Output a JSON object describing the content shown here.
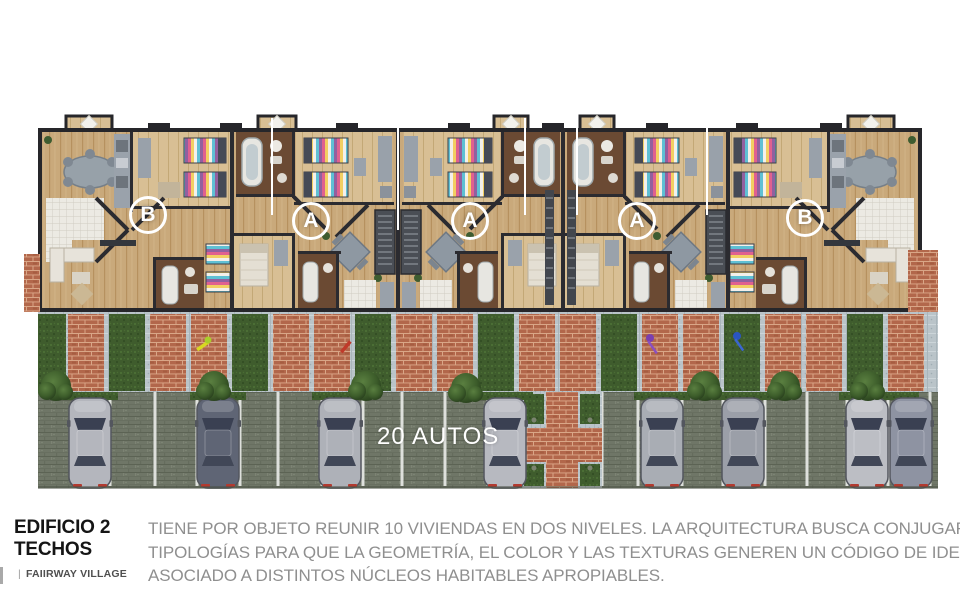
{
  "plan": {
    "units": [
      {
        "label": "B"
      },
      {
        "label": "A"
      },
      {
        "label": "A"
      },
      {
        "label": "A"
      },
      {
        "label": "B"
      }
    ],
    "parking_label": "20 AUTOS",
    "visible_cars": 8
  },
  "footer": {
    "title_line1": "EDIFICIO 2",
    "title_line2": "TECHOS",
    "brand_separator": "|",
    "brand": "FAIIRWAY VILLAGE",
    "description_lines": [
      "TIENE POR OBJETO REUNIR 10 VIVIENDAS EN DOS NIVELES. LA ARQUITECTURA BUSCA CONJUGAR DOS",
      "TIPOLOGÍAS PARA QUE LA GEOMETRÍA, EL COLOR Y LAS TEXTURAS GENEREN UN CÓDIGO DE IDENTIDAD",
      "ASOCIADO A DISTINTOS NÚCLEOS HABITABLES APROPIABLES."
    ]
  },
  "colors": {
    "wood": "#c9a97b",
    "wall": "#2b2b30",
    "brick": "#b2674b",
    "grass": "#3f5c2d",
    "paver": "#bac4c9",
    "parking_pavement": "#6f7667",
    "label_white": "#ffffff",
    "title_text": "#151515",
    "body_text": "#8f8f8f"
  }
}
